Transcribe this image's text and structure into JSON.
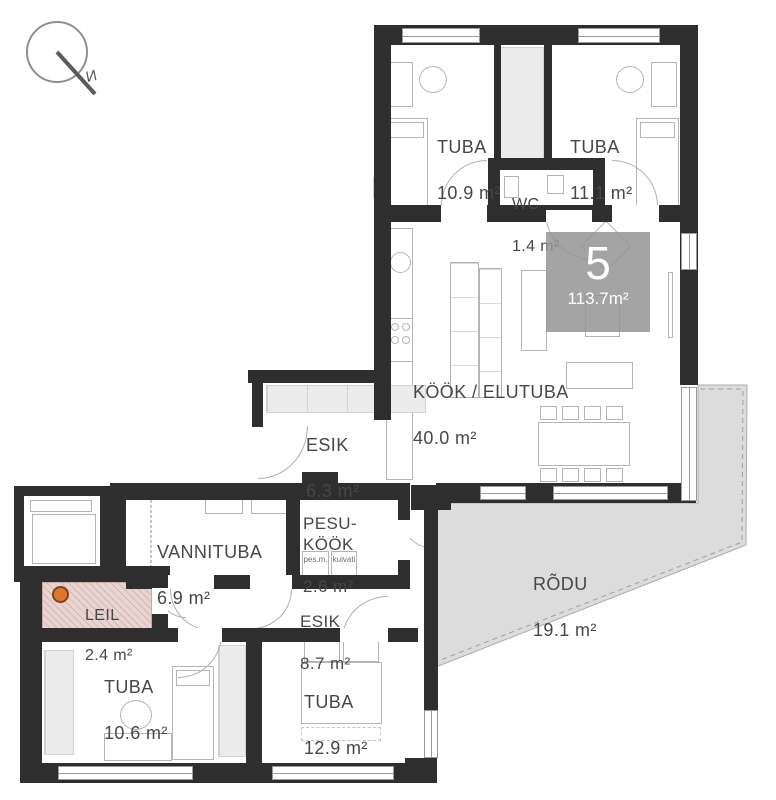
{
  "compass": {
    "north_label": "N"
  },
  "unit_badge": {
    "number": "5",
    "total_area": "113.7m²"
  },
  "rooms": {
    "tuba_a": {
      "name": "TUBA",
      "area": "10.9 m²"
    },
    "tuba_b": {
      "name": "TUBA",
      "area": "11.1 m²"
    },
    "wc": {
      "name": "WC",
      "area": "1.4 m²"
    },
    "kook_elutuba": {
      "name": "KÖÖK / ELUTUBA",
      "area": "40.0 m²"
    },
    "esik_a": {
      "name": "ESIK",
      "area": "6.3 m²"
    },
    "vannituba": {
      "name": "VANNITUBA",
      "area": "6.9 m²"
    },
    "pesukook": {
      "name": "PESU-KÖÖK",
      "area": "2.6 m²"
    },
    "leil": {
      "name": "LEIL",
      "area": "2.4 m²"
    },
    "esik_b": {
      "name": "ESIK",
      "area": "8.7 m²"
    },
    "tuba_c": {
      "name": "TUBA",
      "area": "10.6 m²"
    },
    "tuba_d": {
      "name": "TUBA",
      "area": "12.9 m²"
    },
    "rodu": {
      "name": "RÕDU",
      "area": "19.1 m²"
    }
  },
  "appliances": {
    "washing_machine": "pes.m.",
    "dryer": "kuivati"
  },
  "colors": {
    "wall": "#2e2e2e",
    "balcony_fill": "#dcdcdc",
    "badge_bg": "#949494",
    "sauna_heater": "#e2762d",
    "leil_fill": "#e8d4d0"
  }
}
